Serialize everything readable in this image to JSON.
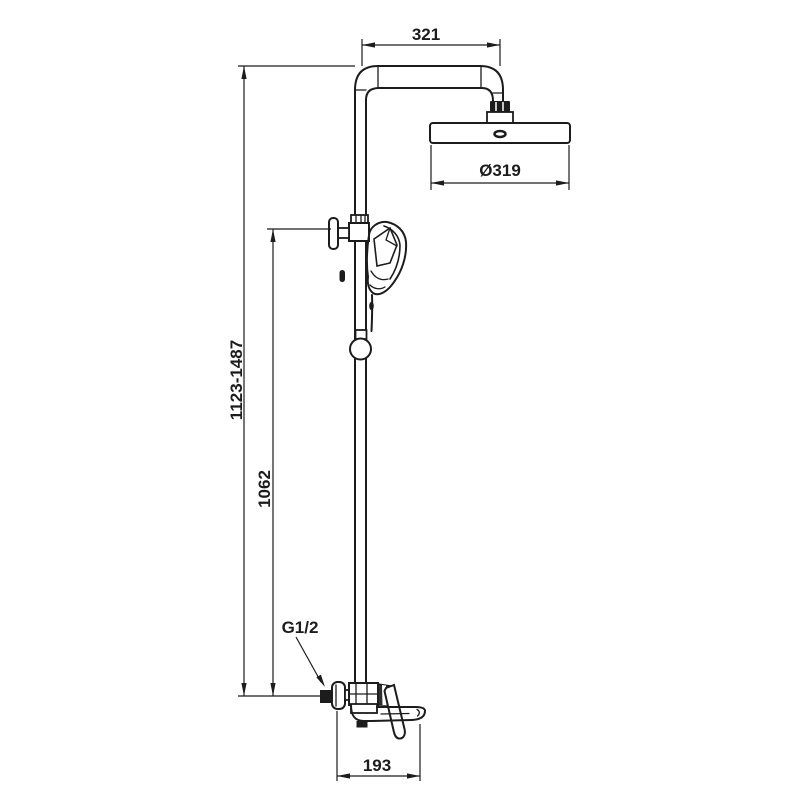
{
  "colors": {
    "line": "#1c1c1c",
    "background": "#ffffff"
  },
  "dimensions": {
    "arm_projection": {
      "label": "321"
    },
    "head_diameter": {
      "label": "Ø319"
    },
    "height_range": {
      "label": "1123-1487"
    },
    "column_height": {
      "label": "1062"
    },
    "spout_projection": {
      "label": "193"
    },
    "thread": {
      "label": "G1/2"
    }
  }
}
